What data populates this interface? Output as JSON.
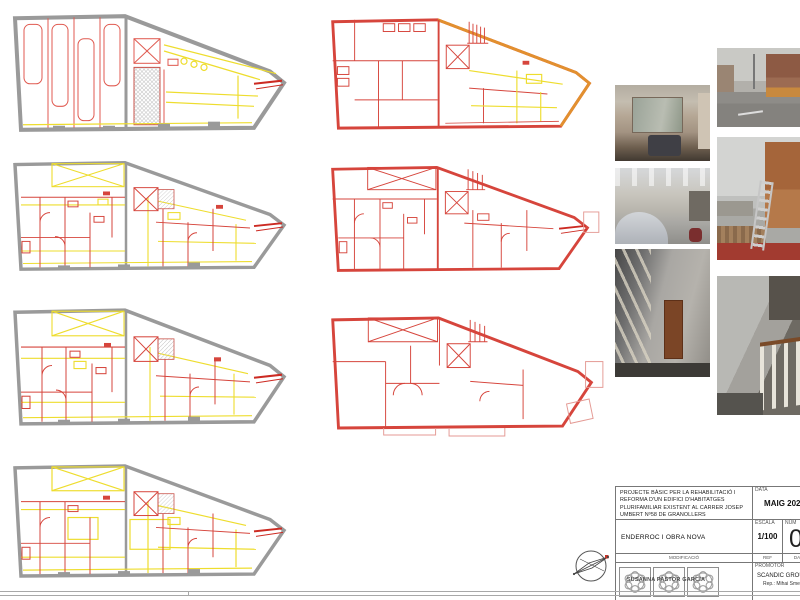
{
  "colors": {
    "existing_wall_gray": "#9a9a9a",
    "demolition_yellow": "#eedd2e",
    "new_work_red": "#d6453c",
    "facade_orange": "#e2902f",
    "sheet_background": "#ffffff",
    "frame_gray": "#a8a8a8"
  },
  "title_block": {
    "project_description": "PROJECTE BÀSIC PER LA REHABILITACIÓ I REFORMA D'UN EDIFICI D'HABITATGES PLURIFAMILIAR EXISTENT AL CARRER JOSEP UMBERT Nº58 DE GRANOLLERS",
    "date_label": "DATA",
    "date_value": "MAIG 2023",
    "drawing_title": "ENDERROC I OBRA NOVA",
    "scale_label": "ESCALA",
    "scale_value": "1/100",
    "number_label": "NÚM",
    "number_value": "0",
    "revision_label": "MODIFICACIÓ",
    "ref_label": "REF",
    "rev_date_label": "DATA",
    "promoter_label": "PROMOTOR",
    "promoter_name": "SCANDIC GROUP 19",
    "promoter_rep": "Rep.: Mihai Smetana",
    "stamp_name": "SUSANNA PASTOR GARCIA"
  }
}
